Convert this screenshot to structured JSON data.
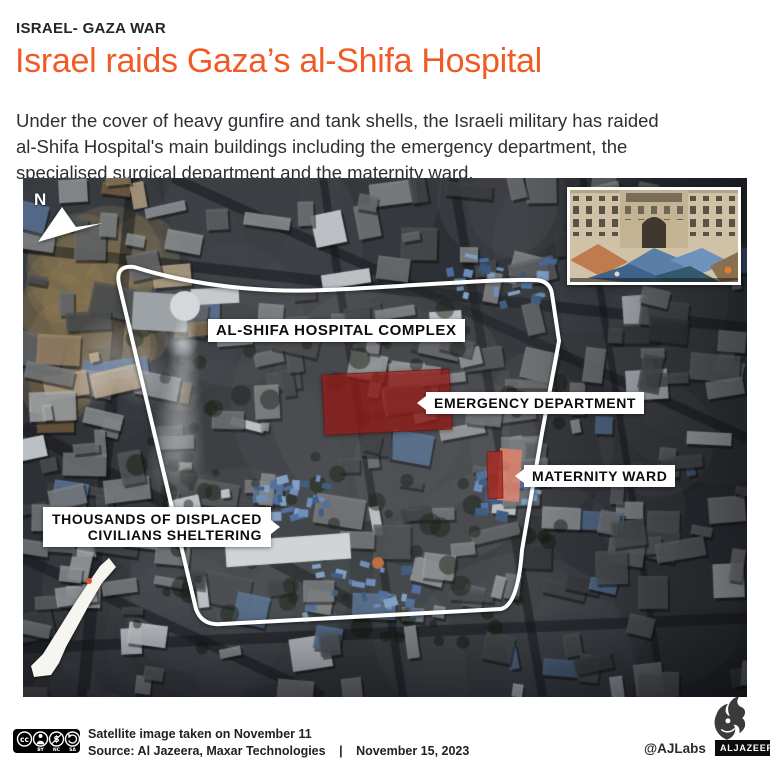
{
  "header": {
    "kicker": "ISRAEL- GAZA WAR",
    "title": "Israel raids Gaza’s al-Shifa Hospital",
    "description_lines": [
      "Under the cover of heavy gunfire and tank shells, the Israeli military has raided",
      "al-Shifa Hospital's main buildings including the emergency department, the",
      "specialised surgical department and the maternity ward."
    ]
  },
  "map": {
    "north_label": "N",
    "labels": {
      "complex": "AL-SHIFA HOSPITAL COMPLEX",
      "emergency": "EMERGENCY DEPARTMENT",
      "maternity": "MATERNITY WARD",
      "displaced_line1": "THOUSANDS OF DISPLACED",
      "displaced_line2": "CIVILIANS SHELTERING"
    },
    "colors": {
      "accent_orange": "#f15a24",
      "outline_white": "#ffffff",
      "emergency_fill": "rgba(172,32,28,0.66)",
      "maternity_dark": "rgba(164,46,38,0.88)",
      "maternity_light": "rgba(224,132,108,0.85)",
      "locator_marker": "#e65325"
    }
  },
  "footer": {
    "cc_labels": [
      "BY",
      "NC",
      "SA"
    ],
    "caption_line1": "Satellite image taken on November 11",
    "source": "Source: Al Jazeera, Maxar Technologies",
    "separator": "|",
    "date": "November 15, 2023",
    "credit_handle": "@AJLabs",
    "brand_wordmark": "ALJAZEERA"
  }
}
